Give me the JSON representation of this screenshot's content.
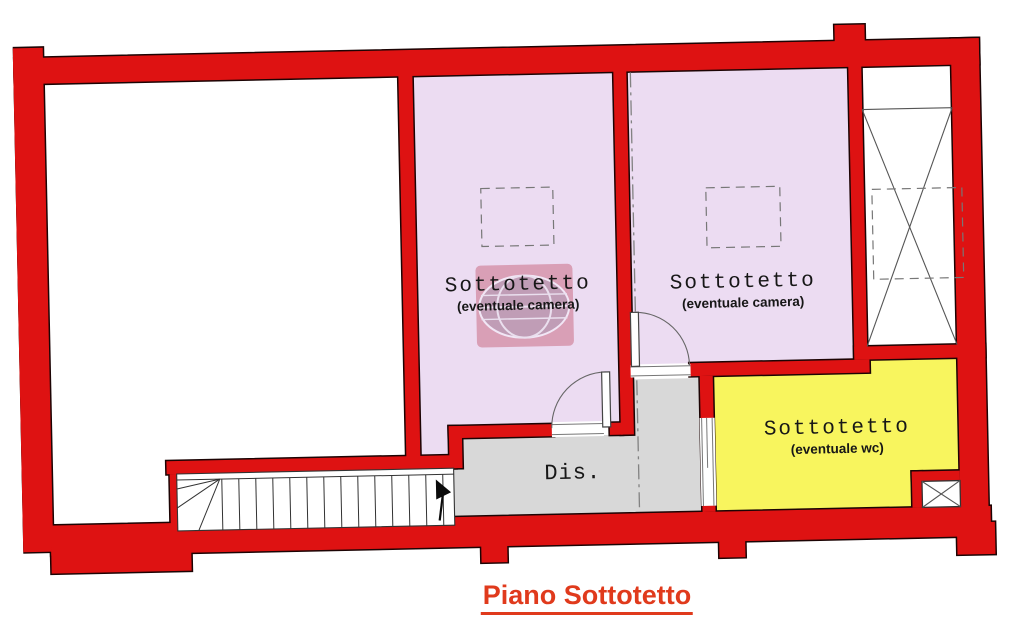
{
  "title": "Piano Sottotetto",
  "colors": {
    "wall": "#de1212",
    "wall_outline": "#1c0404",
    "room_camera": "#ecdcf2",
    "room_wc": "#f8f55e",
    "room_dis": "#d8d8d8",
    "title": "#e03a1c"
  },
  "rooms": {
    "camera_left": {
      "label": "Sottotetto",
      "sublabel": "(eventuale camera)"
    },
    "camera_right": {
      "label": "Sottotetto",
      "sublabel": "(eventuale camera)"
    },
    "wc": {
      "label": "Sottotetto",
      "sublabel": "(eventuale wc)"
    },
    "dis": {
      "label": "Dis."
    }
  }
}
